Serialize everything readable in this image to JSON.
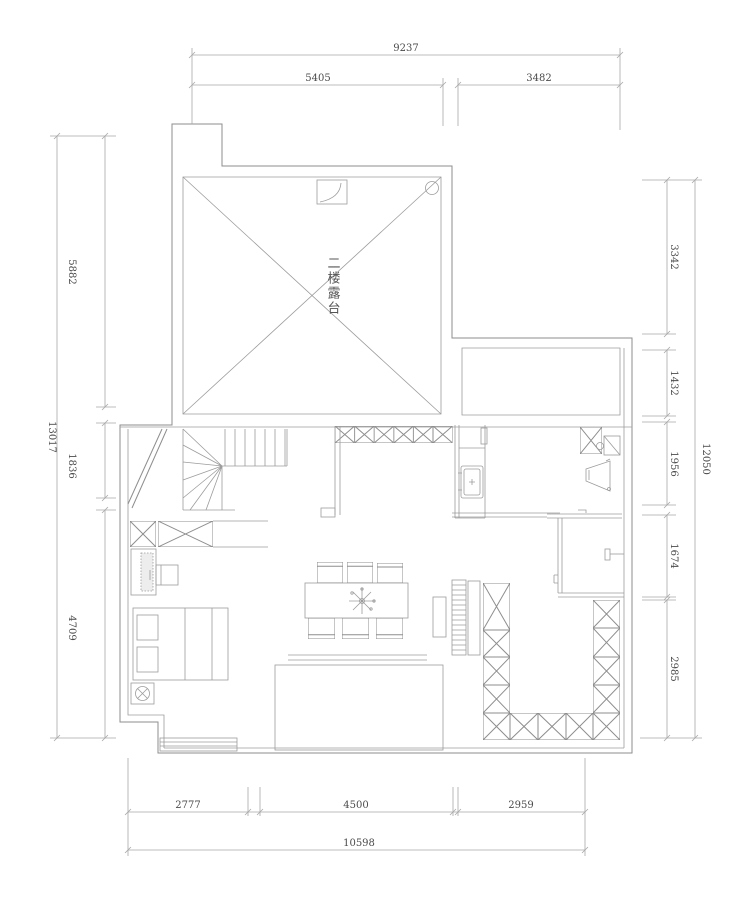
{
  "drawing": {
    "title": "second-floor plan (CAD)",
    "center_label": "二楼露台",
    "colors": {
      "wall_line": "#8e8e8e",
      "dimension_line": "#a9a9a9",
      "text": "#4b4b4b",
      "background": "#ffffff"
    },
    "dims": {
      "top": {
        "overall": "9237",
        "segments": [
          "5405",
          "3482"
        ]
      },
      "bottom": {
        "overall": "10598",
        "segments": [
          "2777",
          "4500",
          "2959"
        ]
      },
      "left": {
        "overall": "13017",
        "segments": [
          "5882",
          "1836",
          "4709"
        ]
      },
      "right": {
        "overall": "12050",
        "segments": [
          "3342",
          "1432",
          "1956",
          "1674",
          "2985"
        ]
      }
    }
  }
}
